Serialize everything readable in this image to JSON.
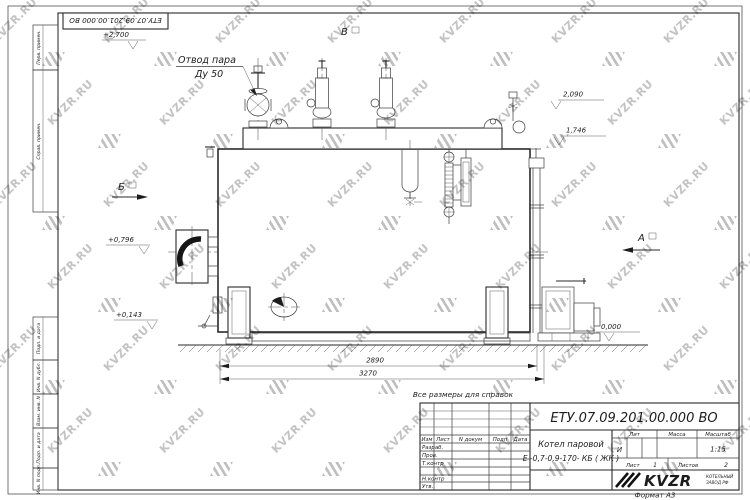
{
  "watermark": {
    "text": "KVZR.RU"
  },
  "corner_stamp": {
    "doc_number": "ЕТУ.07.09.201.00.000  ВО"
  },
  "frame": {
    "left_labels": [
      "Перв. примен.",
      "Справ. примен.",
      "Подп. и дата",
      "Инв. N дубл.",
      "Взам. инв. N",
      "Подп. и дата",
      "Инв. N подл."
    ],
    "format_note": "Формат А3"
  },
  "drawing": {
    "note": "Все размеры для справок",
    "callout": {
      "line1": "Отвод пара",
      "line2": "Ду 50"
    },
    "views": {
      "a": "А",
      "b": "Б",
      "v": "В"
    },
    "levels": {
      "top": "+2,700",
      "steam": "2,090",
      "mid": "1,746",
      "burner": "+0,796",
      "low": "+0,143",
      "ground": "0,000"
    },
    "dims": {
      "inner": "2890",
      "overall": "3270"
    }
  },
  "title_block": {
    "doc_number": "ЕТУ.07.09.201.00.000  ВО",
    "product_line1": "Котел паровой",
    "product_line2": "Е -0,7-0,9-170- КБ ( ЖК )",
    "header_cells": [
      "Изм",
      "Лист",
      "N докум",
      "Подп",
      "Дата"
    ],
    "sign_rows": [
      "Разраб.",
      "Пров.",
      "Т.контр",
      "Н.контр",
      "Утв."
    ],
    "lit_label": "Лит",
    "lit_value": "И",
    "mass_label": "Масса",
    "scale_label": "Масштаб",
    "scale_value": "1:15",
    "sheet_label": "Лист",
    "sheet_value": "1",
    "sheets_label": "Листов",
    "sheets_value": "2",
    "company": {
      "name": "KVZR",
      "tagline1": "КОТЕЛЬНЫЙ",
      "tagline2": "ЗАВОД РФ"
    }
  }
}
